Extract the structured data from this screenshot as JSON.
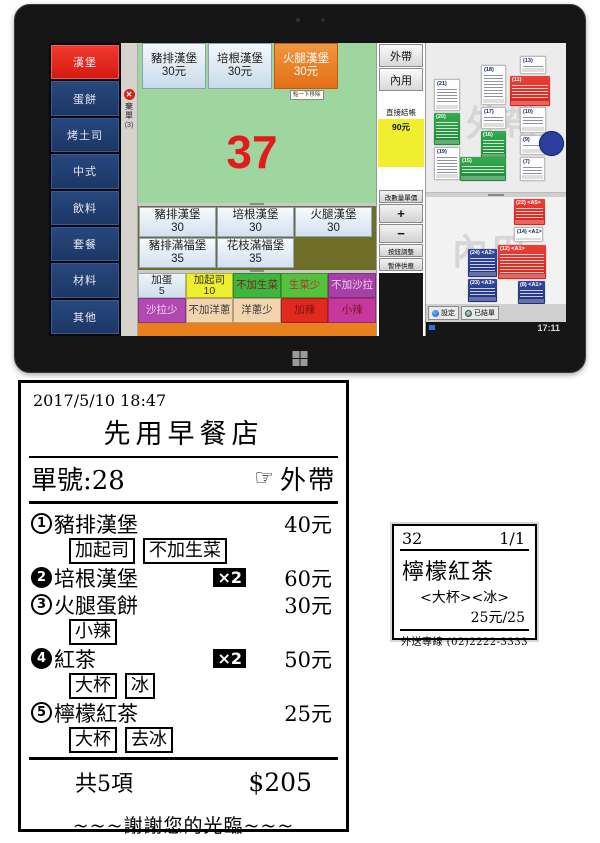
{
  "pos": {
    "sidebar": {
      "items": [
        "漢堡",
        "蛋餅",
        "烤土司",
        "中式",
        "飲料",
        "套餐",
        "材料",
        "其他"
      ]
    },
    "discard": {
      "label": "棄單",
      "count": "(3)"
    },
    "menu_top": [
      {
        "name": "豬排漢堡",
        "price": "30元"
      },
      {
        "name": "培根漢堡",
        "price": "30元"
      },
      {
        "name": "火腿漢堡",
        "price": "30元"
      }
    ],
    "tooltip": "點一下移除",
    "order_number": "37",
    "menu_mid": [
      {
        "name": "豬排漢堡",
        "price": "30"
      },
      {
        "name": "培根漢堡",
        "price": "30"
      },
      {
        "name": "火腿漢堡",
        "price": "30"
      },
      {
        "name": "豬排滿福堡",
        "price": "35"
      },
      {
        "name": "花枝滿福堡",
        "price": "35"
      }
    ],
    "toppings_row1": [
      {
        "label": "加蛋",
        "price": "5"
      },
      {
        "label": "加起司",
        "price": "10"
      },
      {
        "label": "不加生菜"
      },
      {
        "label": "生菜少"
      },
      {
        "label": "不加沙拉"
      }
    ],
    "toppings_row2": [
      {
        "label": "沙拉少"
      },
      {
        "label": "不加洋蔥"
      },
      {
        "label": "洋蔥少"
      },
      {
        "label": "加辣"
      },
      {
        "label": "小辣"
      }
    ],
    "actions": {
      "takeout": "外帶",
      "dinein": "內用",
      "checkout_label": "直接結帳",
      "checkout_amount": "90元",
      "qty_price": "改數量單價",
      "plus": "+",
      "minus": "−",
      "btn_adjust": "按鈕調整",
      "pause": "暫停供應"
    },
    "orders_top": {
      "watermark": "外帶",
      "cards": [
        {
          "id": "(21)"
        },
        {
          "id": "(18)"
        },
        {
          "id": "(13)"
        },
        {
          "id": "(11)"
        },
        {
          "id": "(20)"
        },
        {
          "id": "(17)"
        },
        {
          "id": "(10)"
        },
        {
          "id": "(16)"
        },
        {
          "id": "(19)"
        },
        {
          "id": "(15)"
        },
        {
          "id": "(9)"
        },
        {
          "id": "(7)"
        }
      ]
    },
    "orders_bottom": {
      "watermark": "內用",
      "cards": [
        {
          "id": "(22) <A5>"
        },
        {
          "id": "(14) <A1>"
        },
        {
          "id": "(12) <A1>"
        },
        {
          "id": "(24) <A2>"
        },
        {
          "id": "(23) <A3>"
        },
        {
          "id": "(8) <A1>"
        }
      ]
    },
    "taskbar": {
      "settings": "設定",
      "closed_orders": "已結單",
      "time": "17:11"
    }
  },
  "receipt": {
    "datetime": "2017/5/10  18:47",
    "store": "先用早餐店",
    "order_label": "單號:28",
    "hand": "☞",
    "type": "外帶",
    "items": [
      {
        "num": "1",
        "name": "豬排漢堡",
        "qty": "",
        "price": "40元",
        "mods": [
          "加起司",
          "不加生菜"
        ]
      },
      {
        "num": "2",
        "name": "培根漢堡",
        "qty": "×2",
        "price": "60元",
        "mods": []
      },
      {
        "num": "3",
        "name": "火腿蛋餅",
        "qty": "",
        "price": "30元",
        "mods": [
          "小辣"
        ]
      },
      {
        "num": "4",
        "name": "紅茶",
        "qty": "×2",
        "price": "50元",
        "mods": [
          "大杯",
          "冰"
        ]
      },
      {
        "num": "5",
        "name": "檸檬紅茶",
        "qty": "",
        "price": "25元",
        "mods": [
          "大杯",
          "去冰"
        ]
      }
    ],
    "total_label": "共5項",
    "total": "$205",
    "thanks": "~~~謝謝您的光臨~~~"
  },
  "sticker": {
    "number": "32",
    "page": "1/1",
    "item": "檸檬紅茶",
    "mods": "<大杯><冰>",
    "price": "25元/25",
    "hotline": "外送專線  (02)2222-3333"
  },
  "colors": {
    "selected_red": "#e3241c",
    "sidebar_blue": "#1d3a70",
    "selected_orange": "#e87c1e",
    "panel_green": "#9fd6a0",
    "olive": "#6e6e28",
    "checkout_yellow": "#f0ee2e",
    "orange_strip": "#e8801e"
  }
}
